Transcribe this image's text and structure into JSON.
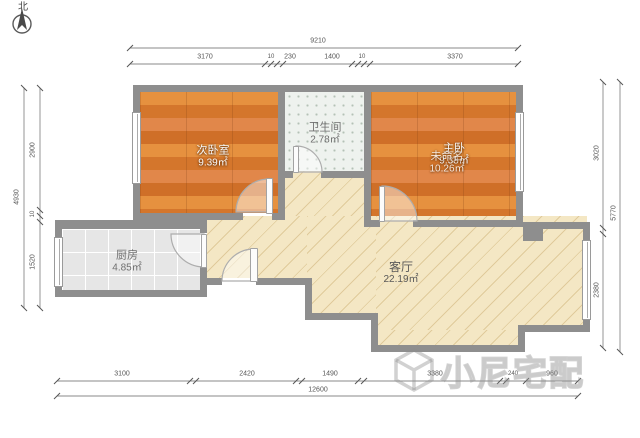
{
  "compass": {
    "label": "北"
  },
  "rooms": {
    "secondary_bedroom": {
      "name": "次卧室",
      "area": "9.39㎡"
    },
    "master_bedroom": {
      "name": "主卧",
      "area": "9.38㎡"
    },
    "master_bedroom_alt": {
      "name": "未命名",
      "area": "10.26㎡"
    },
    "bathroom": {
      "name": "卫生间",
      "area": "2.78㎡"
    },
    "kitchen": {
      "name": "厨房",
      "area": "4.85㎡"
    },
    "living_room": {
      "name": "客厅",
      "area": "22.19㎡"
    }
  },
  "dimensions": {
    "top": {
      "total": "9210",
      "segments": [
        "3170",
        "10",
        "230",
        "1400",
        "10",
        "3370"
      ]
    },
    "bottom": {
      "total": "12600",
      "segments": [
        "3100",
        "2420",
        "1490",
        "3380",
        "240",
        "960"
      ]
    },
    "left": {
      "total": "4930",
      "segments": [
        "2900",
        "10",
        "1520"
      ]
    },
    "right": {
      "total": "5770",
      "segments": [
        "3020",
        "2380"
      ]
    }
  },
  "watermark": {
    "text": "小尼宅配"
  },
  "colors": {
    "wall": "#8e8e8e",
    "wood_floor": "#dd7f33",
    "living_floor": "#f4e7c4",
    "kitchen_tile": "#e6e6e6",
    "bath_tile": "#eef2ee",
    "dim_text": "#555555"
  }
}
